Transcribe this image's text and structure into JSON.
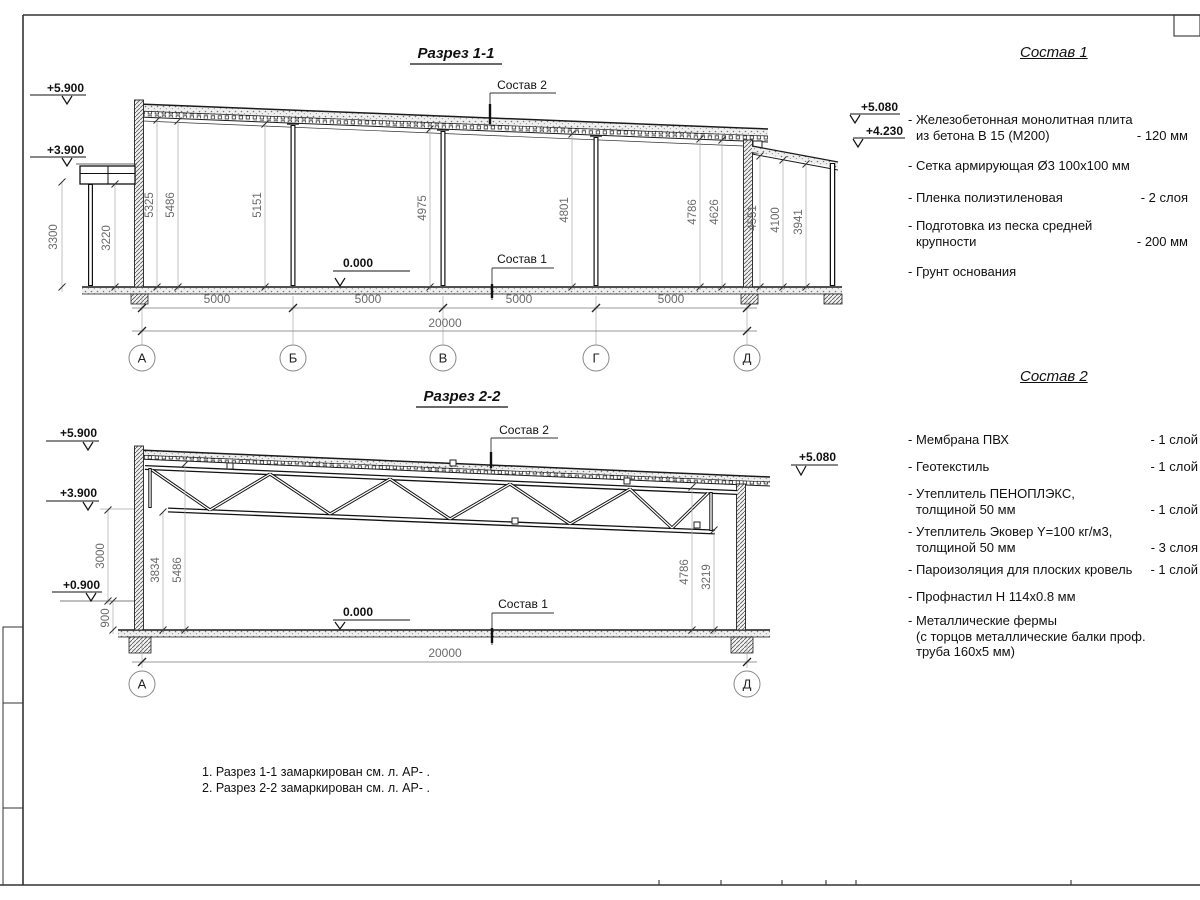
{
  "sheet": {
    "section1": {
      "title": "Разрез 1-1",
      "composition2_label": "Состав 2",
      "composition1_label": "Состав 1",
      "zero_level": "0.000",
      "elevations": {
        "left_top": "+5.900",
        "left_mid": "+3.900",
        "right_top": "+5.080",
        "right_low": "+4.230"
      },
      "heights": {
        "h3300": "3300",
        "h3220": "3220",
        "h5325": "5325",
        "h5486": "5486",
        "h5151": "5151",
        "h4975": "4975",
        "h4801": "4801",
        "h4786": "4786",
        "h4626": "4626",
        "h4551": "4551",
        "h4100": "4100",
        "h3941": "3941"
      },
      "spans": [
        "5000",
        "5000",
        "5000",
        "5000"
      ],
      "total": "20000",
      "axes": [
        "А",
        "Б",
        "В",
        "Г",
        "Д"
      ]
    },
    "section2": {
      "title": "Разрез 2-2",
      "composition2_label": "Состав 2",
      "composition1_label": "Состав 1",
      "zero_level": "0.000",
      "elevations": {
        "left_top": "+5.900",
        "left_mid": "+3.900",
        "left_low": "+0.900",
        "right_top": "+5.080"
      },
      "heights": {
        "h3000": "3000",
        "h900": "900",
        "h3834": "3834",
        "h5486": "5486",
        "h4786": "4786",
        "h3219": "3219"
      },
      "total": "20000",
      "axes": [
        "А",
        "Д"
      ]
    },
    "composition1": {
      "title": "Состав 1",
      "items": [
        {
          "lines": [
            "- Железобетонная  монолитная плита",
            "из бетона В 15 (М200)"
          ],
          "value": "- 120 мм"
        },
        {
          "lines": [
            "- Сетка армирующая Ø3 100х100 мм"
          ],
          "value": ""
        },
        {
          "lines": [
            "- Пленка полиэтиленовая"
          ],
          "value": "- 2 слоя"
        },
        {
          "lines": [
            "- Подготовка из песка средней",
            "крупности"
          ],
          "value": "- 200 мм"
        },
        {
          "lines": [
            "- Грунт основания"
          ],
          "value": ""
        }
      ]
    },
    "composition2": {
      "title": "Состав 2",
      "items": [
        {
          "lines": [
            "- Мембрана ПВХ"
          ],
          "value": "- 1 слой"
        },
        {
          "lines": [
            "- Геотекстиль"
          ],
          "value": "- 1 слой"
        },
        {
          "lines": [
            "- Утеплитель ПЕНОПЛЭКС,",
            "толщиной 50 мм"
          ],
          "value": "- 1 слой"
        },
        {
          "lines": [
            "- Утеплитель Эковер Y=100 кг/м3,",
            "толщиной 50 мм"
          ],
          "value": "- 3 слоя"
        },
        {
          "lines": [
            "- Пароизоляция для плоских кровель"
          ],
          "value": "- 1 слой"
        },
        {
          "lines": [
            "- Профнастил Н 114х0.8 мм"
          ],
          "value": ""
        },
        {
          "lines": [
            "- Металлические фермы",
            "(с торцов металлические балки проф.",
            "труба 160х5 мм)"
          ],
          "value": ""
        }
      ]
    },
    "notes": [
      "1. Разрез 1-1 замаркирован см. л. АР- .",
      "2. Разрез 2-2 замаркирован см. л. АР- ."
    ]
  }
}
